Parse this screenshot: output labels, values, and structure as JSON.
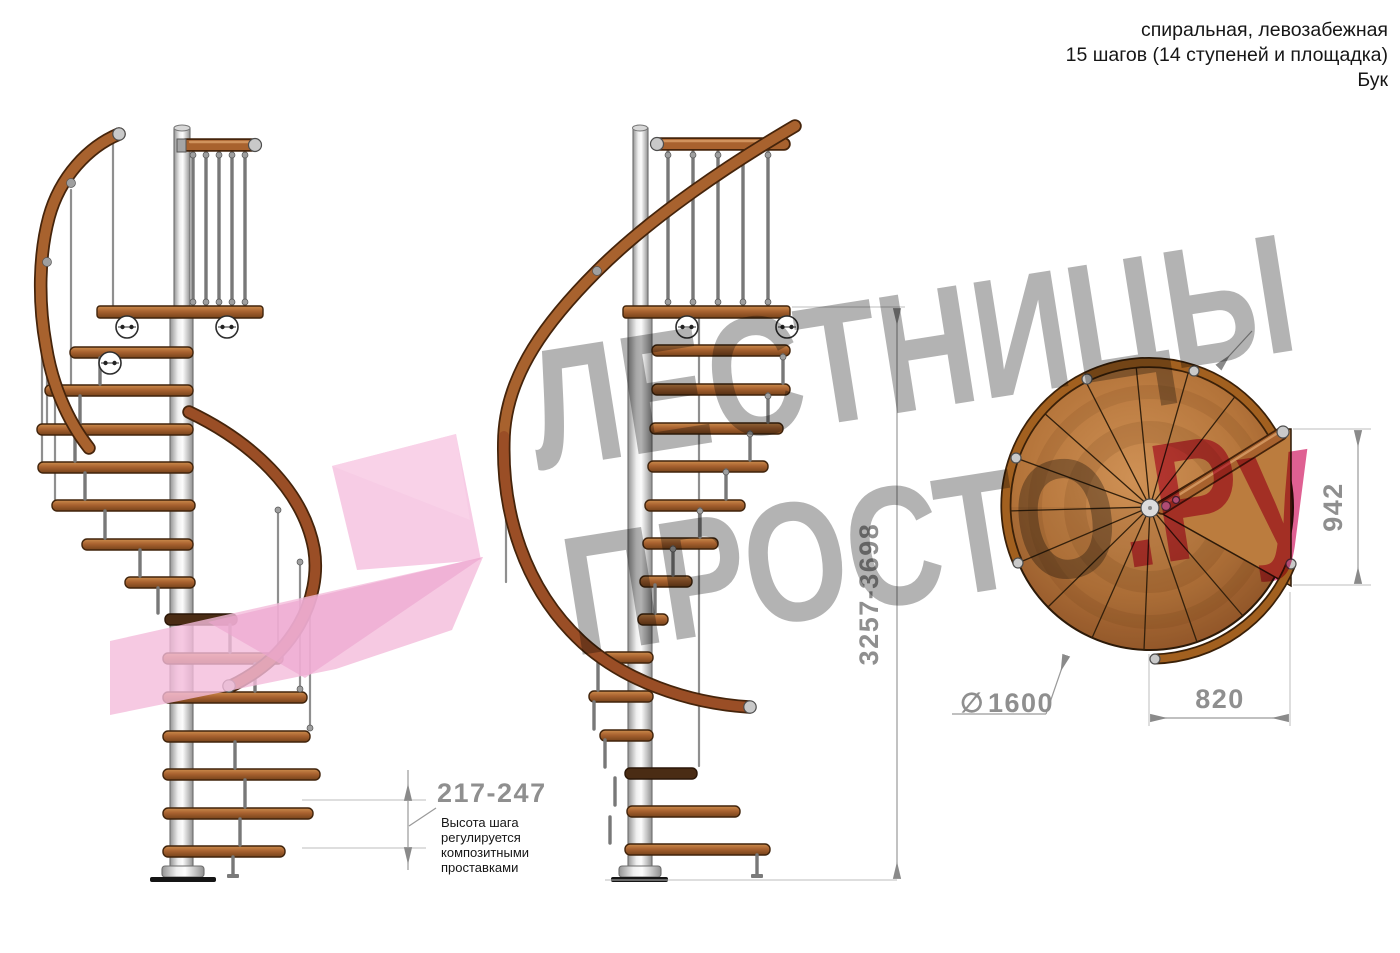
{
  "header": {
    "line1": "спиральная, левозабежная",
    "line2": "15 шагов (14 ступеней и площадка)",
    "line3": "Бук"
  },
  "watermark": {
    "brand_top": "ЛЕСТНИЦЫ",
    "brand_bottom": "ПРОСТО",
    "brand_suffix": ".Ру",
    "gray_color": "#ababab",
    "pink_text_color": "#dc4f86",
    "logo_pink_light": "#f6c3e1",
    "logo_pink_mid": "#f4bcdb",
    "logo_pink_dark": "#eda6cf"
  },
  "dimensions": {
    "step_height": {
      "value": "217-247",
      "note_lines": [
        "Высота шага",
        "регулируется",
        "композитными",
        "проставками"
      ]
    },
    "total_height": "3257-3698",
    "plan_height": "942",
    "plan_width": "820",
    "diameter_symbol": "∅",
    "diameter_value": "1600"
  },
  "colors": {
    "wood_mid": "#a8622e",
    "wood_dark": "#77431a",
    "metal_pole": "#efefef",
    "outline": "#40240c",
    "dimension_gray": "#8f8f8f",
    "note_text": "#161616"
  }
}
